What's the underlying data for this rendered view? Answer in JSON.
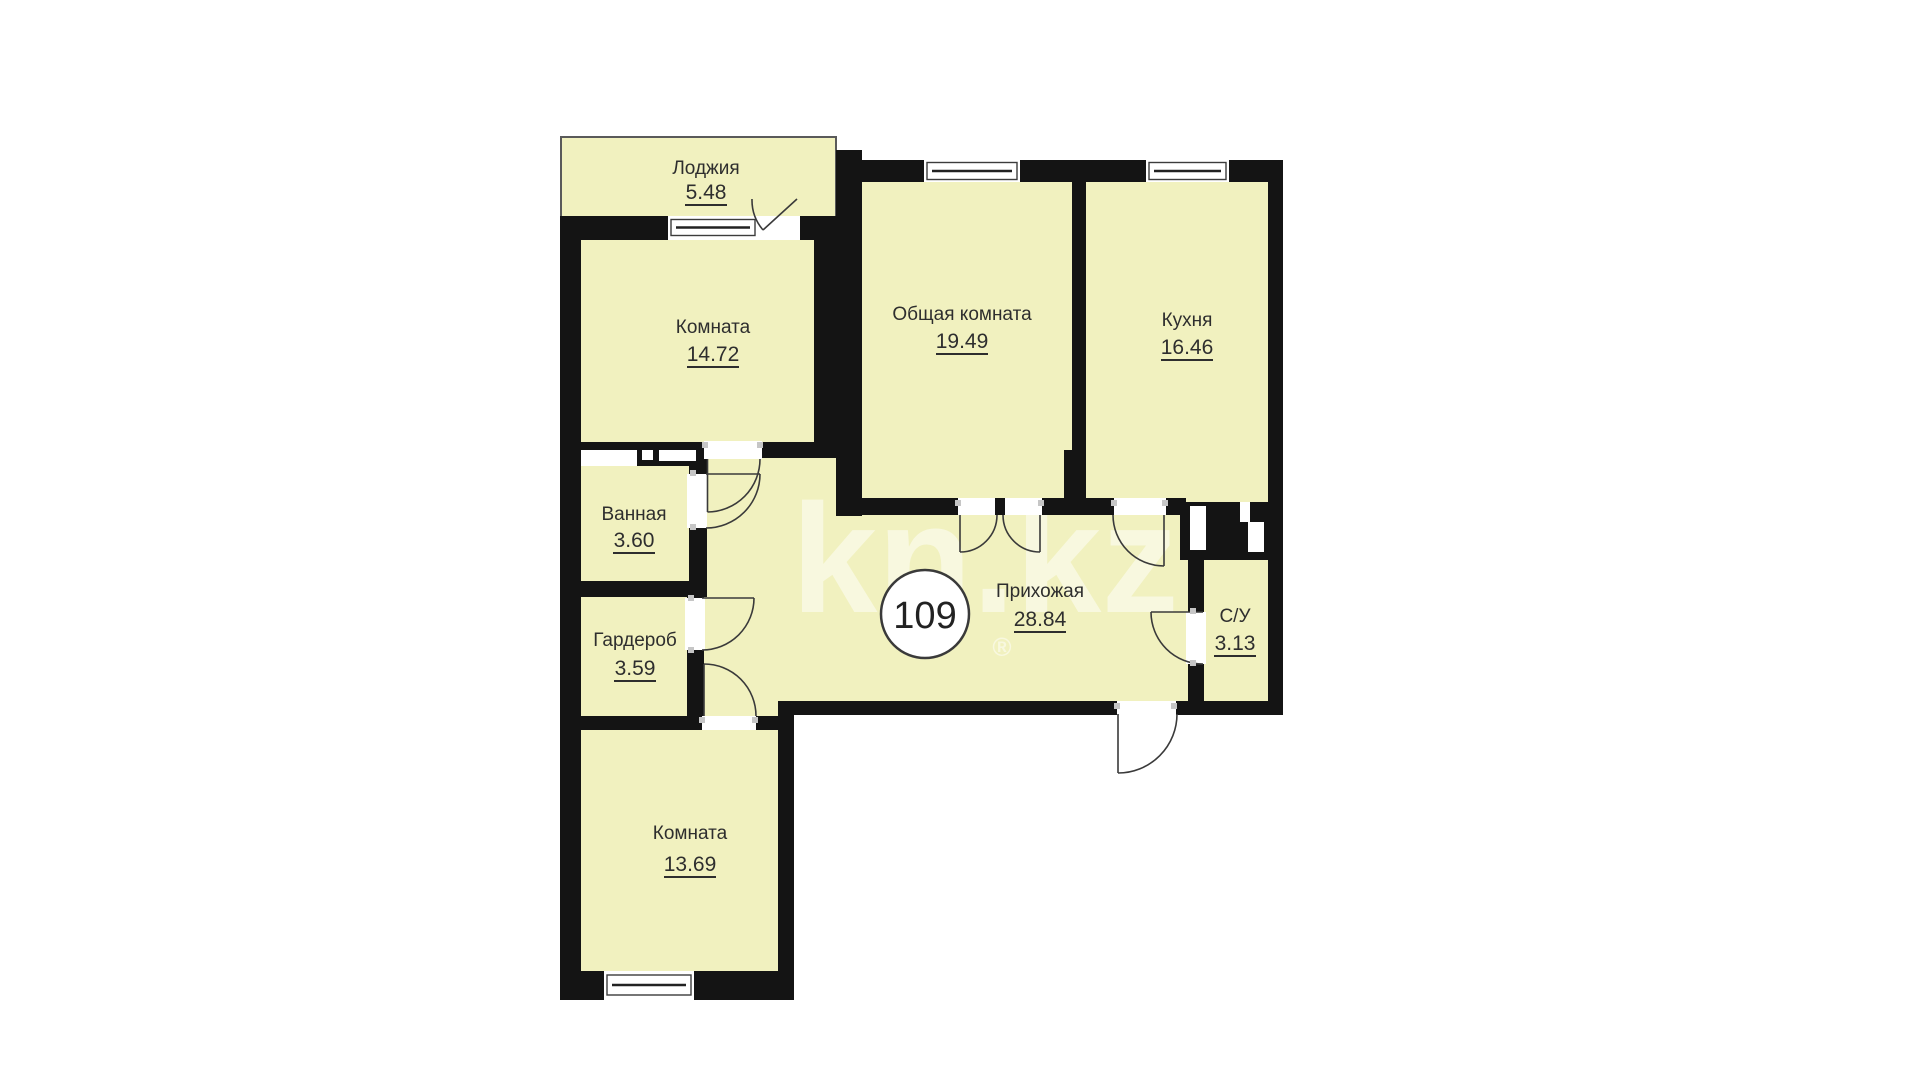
{
  "page": {
    "background": "#ffffff"
  },
  "plan": {
    "unit_number": "109",
    "watermark": "kn.kz",
    "watermark_reg": "®",
    "colors": {
      "fill": "#f1f1bf",
      "wall": "#141414",
      "line": "#3a3a3a",
      "opening": "#ffffff"
    },
    "rooms": [
      {
        "id": "loggia",
        "name": "Лоджия",
        "area": "5.48"
      },
      {
        "id": "room-top",
        "name": "Комната",
        "area": "14.72"
      },
      {
        "id": "living",
        "name": "Общая комната",
        "area": "19.49"
      },
      {
        "id": "kitchen",
        "name": "Кухня",
        "area": "16.46"
      },
      {
        "id": "bathroom",
        "name": "Ванная",
        "area": "3.60"
      },
      {
        "id": "wardrobe",
        "name": "Гардероб",
        "area": "3.59"
      },
      {
        "id": "hallway",
        "name": "Прихожая",
        "area": "28.84"
      },
      {
        "id": "wc",
        "name": "С/У",
        "area": "3.13"
      },
      {
        "id": "room-bottom",
        "name": "Комната",
        "area": "13.69"
      }
    ]
  }
}
